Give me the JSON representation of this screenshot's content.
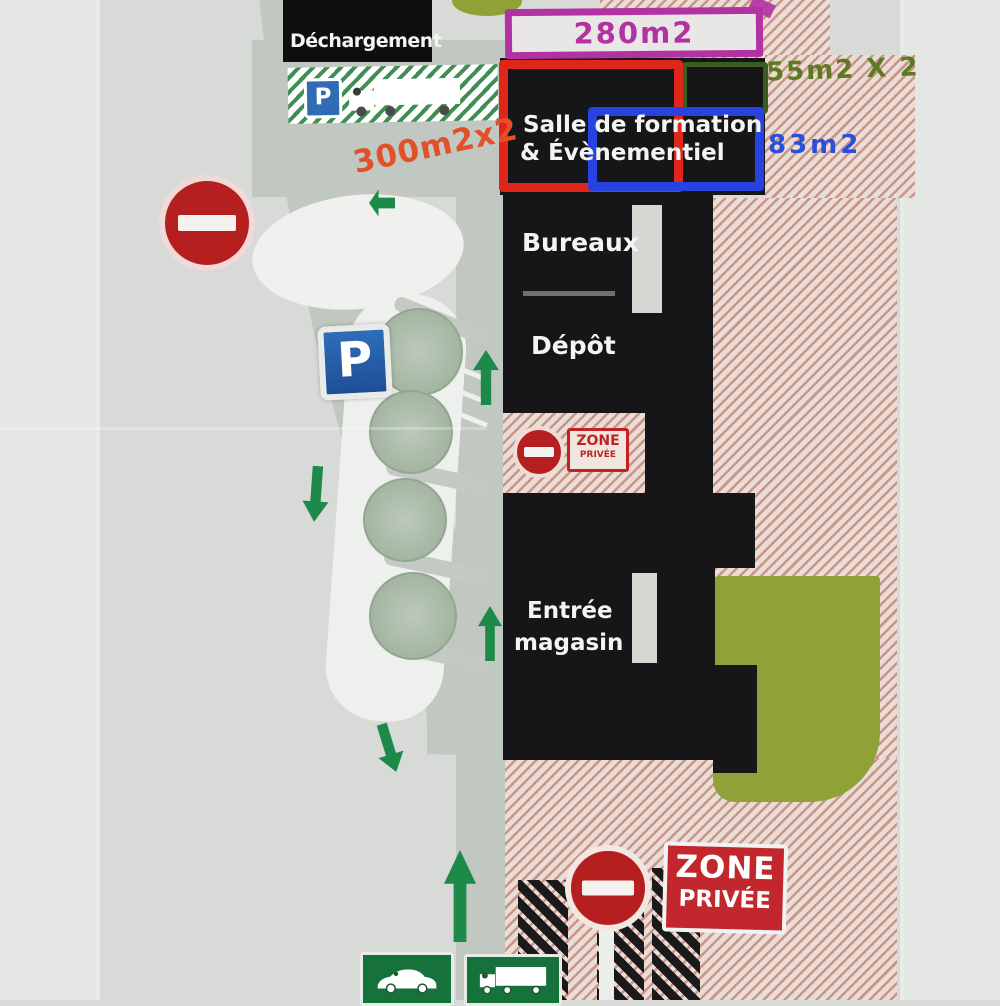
{
  "plan": {
    "loading_label": "Déchargement",
    "annotations": {
      "area_300": "300m2x2",
      "area_280": "280m2",
      "area_55": "55m2 X 2",
      "area_83": "83m2"
    },
    "buildings": {
      "salle_line1": "Salle de formation",
      "salle_line2": "& Évènementiel",
      "bureaux": "Bureaux",
      "depot": "Dépôt",
      "entree_line1": "Entrée",
      "entree_line2": "magasin"
    },
    "signs": {
      "parking": "P",
      "parking_small": "P",
      "zone_small_line1": "ZONE",
      "zone_small_line2": "PRIVÉE",
      "zone_large_line1": "ZONE",
      "zone_large_line2": "PRIVÉE"
    },
    "colors": {
      "annotation_orange": "#e2502a",
      "annotation_magenta": "#b232a2",
      "annotation_green": "#5c7a22",
      "annotation_blue": "#2b4fd7",
      "outline_red": "#e0251a",
      "outline_blue": "#2742e0",
      "outline_dark_green": "#3a5c20",
      "zone_red": "#c1272d",
      "arrow_green": "#1e8a49",
      "olive": "#8fa137",
      "building_black": "#161618"
    }
  }
}
